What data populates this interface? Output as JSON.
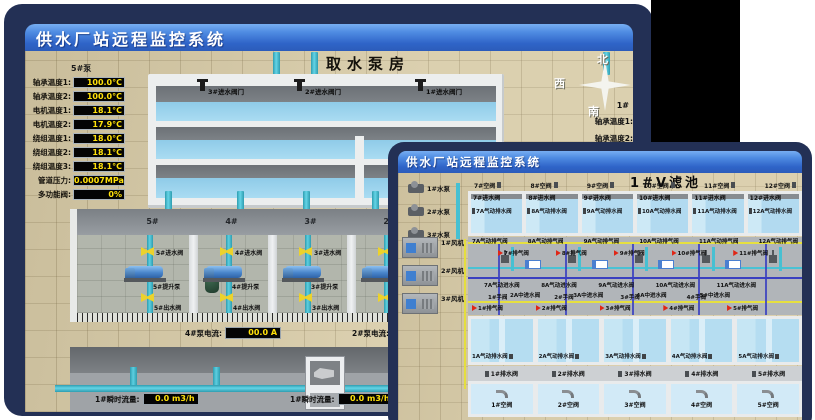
{
  "back_window": {
    "title": "供水厂站远程监控系统",
    "heading": "取水泵房",
    "pump_panel": {
      "header": "5#泵",
      "rows": [
        {
          "label": "轴承温度1:",
          "value": "100.0°C"
        },
        {
          "label": "轴承温度2:",
          "value": "100.0°C"
        },
        {
          "label": "电机温度1:",
          "value": "18.1°C"
        },
        {
          "label": "电机温度2:",
          "value": "17.9°C"
        },
        {
          "label": "绕组温度1:",
          "value": "18.0°C"
        },
        {
          "label": "绕组温度2:",
          "value": "18.1°C"
        },
        {
          "label": "绕组温度3:",
          "value": "18.1°C"
        },
        {
          "label": "管道压力:",
          "value": "0.0007MPa"
        },
        {
          "label": "多功能阀:",
          "value": "0%"
        }
      ]
    },
    "intake_valves": [
      "3#进水阀门",
      "2#进水阀门",
      "1#进水阀门"
    ],
    "pump_bays": [
      {
        "bay": "5#",
        "inlet": "5#进水阀",
        "pump": "5#提升泵",
        "outlet": "5#出水阀"
      },
      {
        "bay": "4#",
        "inlet": "4#进水阀",
        "pump": "4#提升泵",
        "outlet": "4#出水阀"
      },
      {
        "bay": "3#",
        "inlet": "3#进水阀",
        "pump": "3#提升泵",
        "outlet": "3#出水阀"
      },
      {
        "bay": "2#",
        "inlet": "",
        "pump": "",
        "outlet": ""
      }
    ],
    "current_readouts": [
      {
        "label": "4#泵电流:",
        "value": "00.0 A"
      },
      {
        "label": "2#泵电流:",
        "value": ""
      }
    ],
    "flow_readouts": [
      {
        "label": "1#瞬时流量:",
        "value": "0.0 m3/h"
      },
      {
        "label": "1#瞬时流量:",
        "value": "0.0 m3/h"
      }
    ],
    "compass": {
      "north": "北",
      "west": "西",
      "south": "南"
    },
    "right_panel": {
      "header": "1#",
      "labels": [
        "轴承温度1:",
        "轴承温度2:"
      ]
    }
  },
  "front_window": {
    "title": "供水厂站远程监控系统",
    "heading": "1#V滤池",
    "pumps": [
      "1#水泵",
      "2#水泵",
      "3#水泵"
    ],
    "blowers": [
      "1#风机",
      "2#风机",
      "3#风机"
    ],
    "top_air_valves": [
      "7#空阀",
      "8#空阀",
      "9#空阀",
      "10#空阀",
      "11#空阀",
      "12#空阀"
    ],
    "upper_cells": [
      {
        "inlet": "7#进水阀",
        "drain": "7A气动排水阀"
      },
      {
        "inlet": "8#进水阀",
        "drain": "8A气动排水阀"
      },
      {
        "inlet": "9#进水阀",
        "drain": "9A气动排水阀"
      },
      {
        "inlet": "10#进水阀",
        "drain": "10A气动排水阀"
      },
      {
        "inlet": "11#进水阀",
        "drain": "11A气动排水阀"
      },
      {
        "inlet": "12#进水阀",
        "drain": "12A气动排水阀"
      }
    ],
    "deck": {
      "exhaust_valves": [
        "7A气动排气阀",
        "8A气动排气阀",
        "9A气动排气阀",
        "10A气动排气阀",
        "11A气动排气阀",
        "12A气动排气阀"
      ],
      "air_release": [
        "7#排气阀",
        "8#排气阀",
        "9#排气阀",
        "10#排气阀",
        "11#排气阀"
      ],
      "mid_inlets": [
        "7A气动进水阀",
        "8A气动进水阀",
        "9A气动进水阀",
        "10A气动进水阀",
        "11A气动进水阀"
      ],
      "center_inlets": [
        "2A中进水阀",
        "3A中进水阀",
        "4A中进水阀",
        "5#中进水阀"
      ],
      "hand_valves": [
        "1#手阀",
        "2#手阀",
        "3#手阀",
        "4#手阀"
      ],
      "air_release2": [
        "1#排气阀",
        "2#排气阀",
        "3#排气阀",
        "4#排气阀",
        "5#排气阀"
      ]
    },
    "lower_cells": [
      {
        "drain": "1A气动排水阀",
        "outlet": "1#排水阀",
        "air": "1#空阀"
      },
      {
        "drain": "2A气动排水阀",
        "outlet": "2#排水阀",
        "air": "2#空阀"
      },
      {
        "drain": "3A气动排水阀",
        "outlet": "3#排水阀",
        "air": "3#空阀"
      },
      {
        "drain": "4A气动排水阀",
        "outlet": "4#排水阀",
        "air": "4#空阀"
      },
      {
        "drain": "5A气动排水阀",
        "outlet": "5#排水阀",
        "air": "5#空阀"
      }
    ]
  }
}
